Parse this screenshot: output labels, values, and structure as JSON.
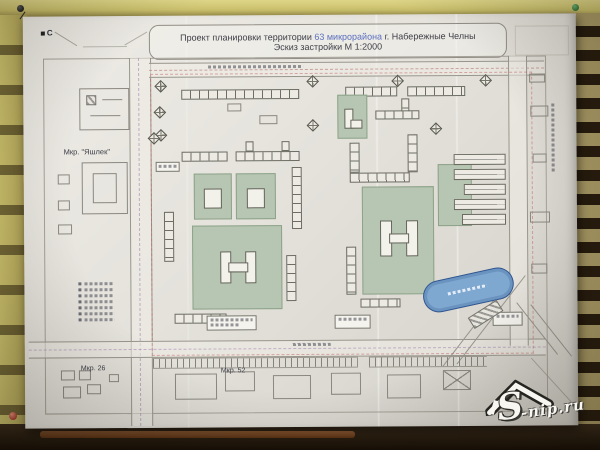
{
  "map": {
    "title": {
      "prefix": "Проект планировки территории ",
      "highlight": "63 микрорайона",
      "suffix": " г. Набережные Челны",
      "subtitle": "Эскиз застройки М 1:2000"
    },
    "north_label": "С",
    "labels": {
      "yashlek": "Мкр. \"Яшлек\"",
      "mkr26": "Мкр. 26",
      "mkr52": "Мкр. 52"
    }
  },
  "watermark": {
    "big": "S",
    "rest": "-nip.ru"
  },
  "colors": {
    "paper": "#e6e4dd",
    "wood": "#c9bf6b",
    "green_area": "#b7c6b2",
    "pond_blue": "#7fa8d0",
    "title_highlight": "#5b6fc0",
    "boundary_red": "#c06060",
    "pin_red": "#b03030",
    "pin_green": "#2f7d36",
    "pin_black": "#1a1a1a"
  }
}
